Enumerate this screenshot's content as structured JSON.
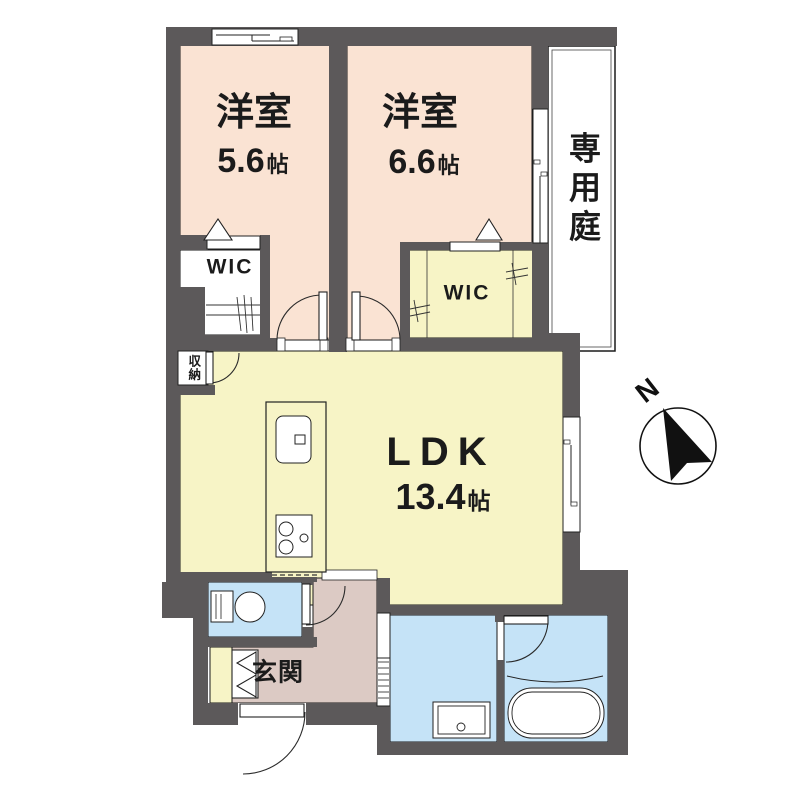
{
  "page_title": "間取り図",
  "floorplan": {
    "rooms": {
      "bedroom_left": {
        "name": "洋室",
        "size": "5.6",
        "unit": "帖"
      },
      "bedroom_right": {
        "name": "洋室",
        "size": "6.6",
        "unit": "帖"
      },
      "ldk": {
        "name": "LDK",
        "size": "13.4",
        "unit": "帖"
      },
      "private_garden": {
        "name": "専用庭"
      },
      "wic_left": {
        "name": "WIC"
      },
      "wic_right": {
        "name": "WIC"
      },
      "storage": {
        "name": "収納"
      },
      "entrance": {
        "name": "玄関"
      }
    },
    "compass": {
      "north_label": "N"
    },
    "colors": {
      "wall": "#5c595a",
      "bedroom": "#fae3d3",
      "ldk": "#f7f4c6",
      "wet_area": "#c5e3f7",
      "hall": "#dccac4",
      "outline": "#1a1a1a",
      "paper": "#ffffff"
    }
  }
}
